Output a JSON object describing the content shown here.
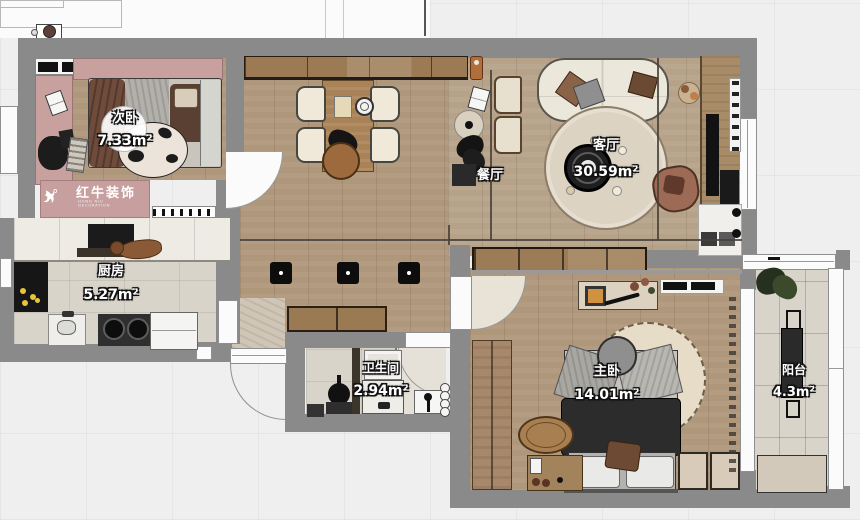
{
  "logo": {
    "brand": "红牛装饰",
    "subtitle": "HONG NIU DECORATION"
  },
  "rooms": {
    "ciwo": {
      "label": "次卧",
      "area": "7.33m²"
    },
    "canting": {
      "label": "餐厅"
    },
    "keting": {
      "label": "客厅",
      "area": "30.59m²"
    },
    "chufang": {
      "label": "厨房",
      "area": "5.27m²"
    },
    "weishengjian": {
      "label": "卫生间",
      "area": "2.94m²"
    },
    "zhuwo": {
      "label": "主卧",
      "area": "14.01m²"
    },
    "yangtai": {
      "label": "阳台",
      "area": "4.3m²"
    }
  },
  "colors": {
    "wall": "#8a8a8a",
    "wood_floor": "#af977b",
    "tile_floor": "#d9d4ca",
    "accent_pink": "#c79f9f",
    "label_text": "#ffffff"
  }
}
